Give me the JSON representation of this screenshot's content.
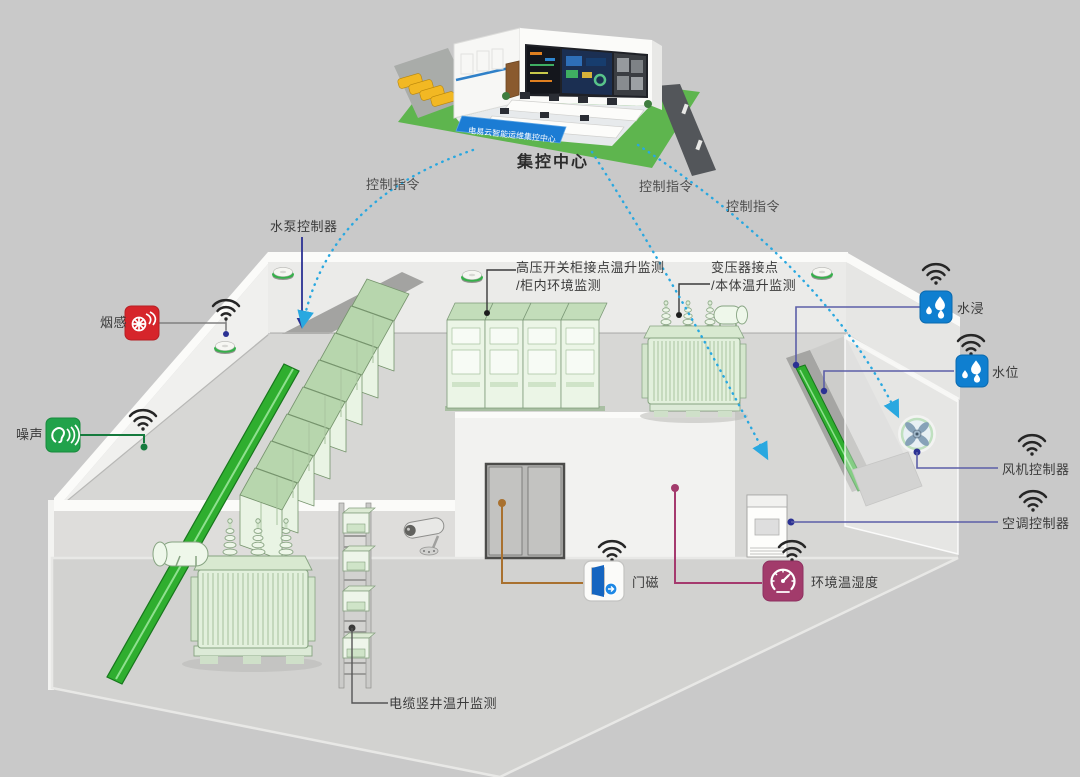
{
  "control_center": {
    "label": "集控中心",
    "banner": "电易云智能运维集控中心"
  },
  "command_labels": [
    {
      "text": "控制指令"
    },
    {
      "text": "控制指令"
    },
    {
      "text": "控制指令"
    }
  ],
  "sensors": {
    "water_pump_controller": {
      "label": "水泵控制器",
      "line_color": "#2b3193"
    },
    "smoke_detector": {
      "label": "烟感",
      "icon_color": "#d6252b"
    },
    "noise_sensor": {
      "label": "噪声",
      "icon_color": "#21a24b",
      "line_color": "#157a3d"
    },
    "hv_cabinet_monitoring": {
      "label_line1": "高压开关柜接点温升监测",
      "label_line2": "/柜内环境监测"
    },
    "transformer_monitoring": {
      "label_line1": "变压器接点",
      "label_line2": "/本体温升监测"
    },
    "water_immersion": {
      "label": "水浸",
      "icon_color": "#0f7fd0"
    },
    "water_level": {
      "label": "水位",
      "icon_color": "#0f7fd0"
    },
    "fan_controller": {
      "label": "风机控制器",
      "line_color": "#5c5fa8"
    },
    "ac_controller": {
      "label": "空调控制器",
      "line_color": "#5c5fa8"
    },
    "door_magnet": {
      "label": "门磁",
      "line_color": "#a9712f"
    },
    "env_temp_humidity": {
      "label": "环境温湿度",
      "icon_color": "#a23b6b"
    },
    "cable_shaft_monitoring": {
      "label": "电缆竖井温升监测"
    }
  },
  "icons": {
    "wifi_icon": "signal arcs + dot",
    "smoke_alarm_icon": "white smoke swirl on red square",
    "noise_icon": "ear with sound waves on green square",
    "water_drops_icon": "three water drops on blue square",
    "door_open_icon": "open door with circled arrow",
    "gauge_icon": "temperature-humidity gauge on magenta square",
    "fan_icon": "round fan with cross blades",
    "cctv_camera_icon": "wall-mounted camera",
    "smoke_detector_disc": "white puck with green ring"
  },
  "colors": {
    "background": "#c9c9c9",
    "command_dashed_line": "#29a8e0",
    "connector_navy": "#2b3193",
    "connector_slate": "#5c5fa8",
    "connector_green": "#157a3d",
    "connector_orange": "#a9712f",
    "connector_magenta": "#a53a6e",
    "equipment_green": "#e2f0dc",
    "duct_green": "#2fae2f",
    "banner_blue": "#1b7cd4"
  }
}
